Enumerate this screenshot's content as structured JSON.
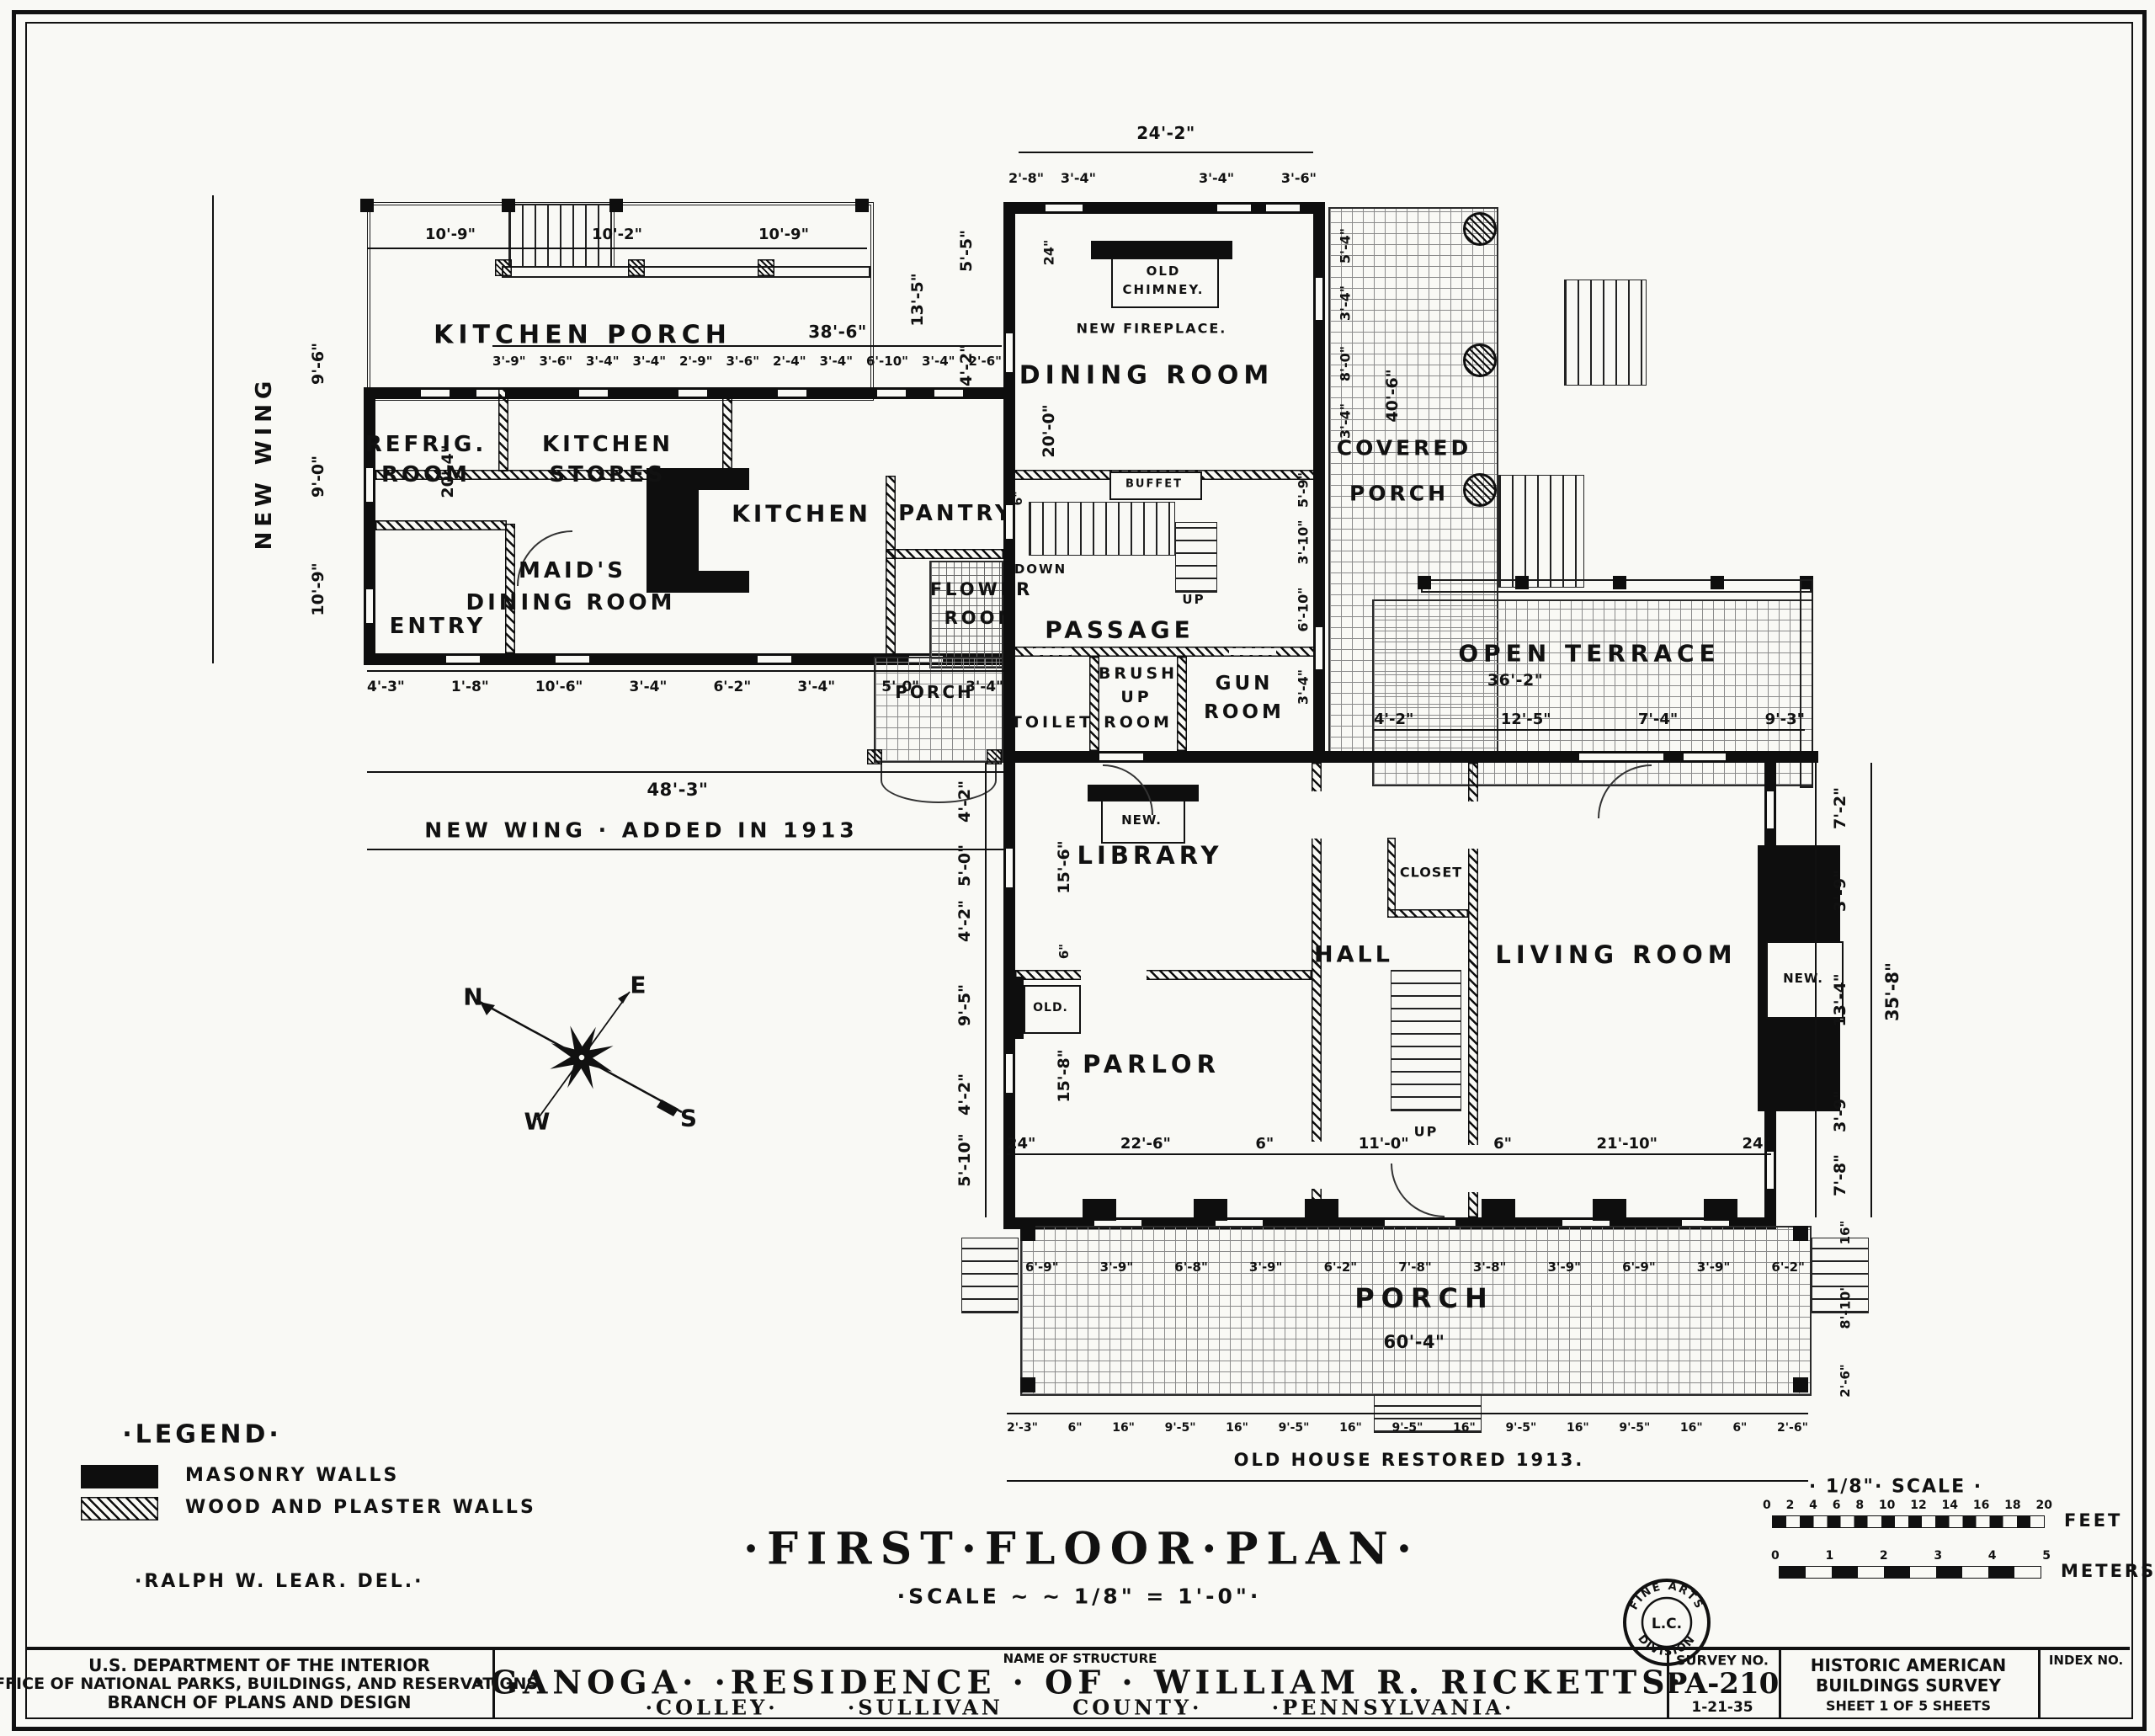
{
  "plan_title": {
    "title": "·FIRST·FLOOR·PLAN·",
    "scale": "·SCALE ~ ~ 1/8\" = 1'-0\"·"
  },
  "legend": {
    "title": "·LEGEND·",
    "masonry": "MASONRY WALLS",
    "wood": "WOOD AND PLASTER WALLS",
    "delineator": "·RALPH W. LEAR. DEL.·"
  },
  "scalebar": {
    "title": "· 1/8\"· SCALE ·",
    "feet_ticks": [
      "0",
      "2",
      "4",
      "6",
      "8",
      "10",
      "12",
      "14",
      "16",
      "18",
      "20"
    ],
    "feet_label": "FEET",
    "meter_ticks": [
      "0",
      "1",
      "2",
      "3",
      "4",
      "5"
    ],
    "meters_label": "METERS"
  },
  "compass": {
    "n": "N",
    "e": "E",
    "w": "W",
    "s": "S"
  },
  "stamp": {
    "arc_top": "FINE ARTS",
    "center": "L.C.",
    "arc_bottom": "DIVISION"
  },
  "titleblock": {
    "agency_line1": "U.S. DEPARTMENT OF THE INTERIOR",
    "agency_line2": "OFFICE OF NATIONAL PARKS, BUILDINGS, AND RESERVATIONS",
    "agency_line3": "BRANCH OF PLANS AND DESIGN",
    "name_label": "NAME OF STRUCTURE",
    "name_main": "·GANOGA·  ·RESIDENCE · OF · WILLIAM R. RICKETTS·",
    "name_sub": "·COLLEY· ·SULLIVAN COUNTY· ·PENNSYLVANIA·",
    "survey_label": "SURVEY NO.",
    "survey_no": "PA-210",
    "survey_date": "1-21-35",
    "habs_line1": "HISTORIC AMERICAN",
    "habs_line2": "BUILDINGS SURVEY",
    "sheet_info": "SHEET 1 OF 5 SHEETS",
    "index_label": "INDEX NO."
  },
  "annotations": {
    "new_wing_added": "NEW WING · ADDED IN 1913",
    "old_house_restored": "OLD HOUSE RESTORED 1913.",
    "new_wing_vertical": "NEW WING",
    "down": "DOWN",
    "up": "UP"
  },
  "rooms": {
    "kitchen_porch": "KITCHEN PORCH",
    "refrig_room": [
      "REFRIG.",
      "ROOM"
    ],
    "kitchen_stores": [
      "KITCHEN",
      "STORES"
    ],
    "kitchen": "KITCHEN",
    "pantry": "PANTRY",
    "maids_dining": [
      "MAID'S",
      "DINING ROOM"
    ],
    "entry": "ENTRY",
    "flower_room": [
      "FLOWER",
      "ROOM"
    ],
    "dining_room": "DINING ROOM",
    "old_chimney": [
      "OLD",
      "CHIMNEY."
    ],
    "new_fireplace": "NEW FIREPLACE.",
    "buffet": "BUFFET",
    "passage": "PASSAGE",
    "toilet": "TOILET",
    "brush_up_room": [
      "BRUSH",
      "UP",
      "ROOM"
    ],
    "gun_room": [
      "GUN",
      "ROOM"
    ],
    "covered_porch": [
      "COVERED",
      "PORCH"
    ],
    "open_terrace": "OPEN TERRACE",
    "library": "LIBRARY",
    "closet": "CLOSET",
    "hall": "HALL",
    "living_room": "LIVING ROOM",
    "parlor": "PARLOR",
    "porch_small": "PORCH",
    "porch_main": "PORCH",
    "fireplace_new": "NEW.",
    "fireplace_old": "OLD."
  },
  "dims": {
    "top_main": "24'-2\"",
    "top_sub_left": [
      "2'-8\"",
      "3'-4\""
    ],
    "top_sub_right": [
      "3'-4\"",
      "3'-6\""
    ],
    "kp_top": [
      "10'-9\"",
      "10'-2\"",
      "10'-9\""
    ],
    "kp_width": "38'-6\"",
    "window_row": [
      "3'-9\"",
      "3'-6\"",
      "3'-4\"",
      "3'-4\"",
      "2'-9\"",
      "3'-6\"",
      "2'-4\"",
      "3'-4\"",
      "6'-10\"",
      "3'-4\"",
      "2'-6\""
    ],
    "kp_right_a": "5'-5\"",
    "kp_right_b": "13'-5\"",
    "kp_right_c": "4'-2\"",
    "wing_left": [
      "9'-6\"",
      "9'-0\"",
      "10'-9\""
    ],
    "wing_depth": "20'-4\"",
    "wing_bottom": [
      "4'-3\"",
      "1'-8\"",
      "10'-6\"",
      "3'-4\"",
      "6'-2\"",
      "3'-4\"",
      "5'-0\"",
      "3'-4\""
    ],
    "wing_total": "48'-3\"",
    "dining_a": "24\"",
    "dining_b": "20'-0\"",
    "passage_a": "6\"",
    "cp_col_upper": [
      "5'-4\"",
      "3'-4\"",
      "8'-0\"",
      "3'-4\""
    ],
    "cp_col_lower": [
      "5'-9\"",
      "3'-10\"",
      "6'-10\"",
      "3'-4\""
    ],
    "cp_width": "40'-6\"",
    "terrace_width": "36'-2\"",
    "terrace_row": [
      "4'-2\"",
      "12'-5\"",
      "7'-4\"",
      "9'-3\""
    ],
    "house_left": [
      "4'-2\"",
      "5'-0\"",
      "4'-2\"",
      "9'-5\"",
      "4'-2\"",
      "5'-10\""
    ],
    "house_left_inner": [
      "15'-6\"",
      "6\"",
      "15'-8\""
    ],
    "south_row": [
      "24\"",
      "22'-6\"",
      "6\"",
      "11'-0\"",
      "6\"",
      "21'-10\"",
      "24\""
    ],
    "house_right": [
      "7'-2\"",
      "3'-9\"",
      "13'-4\"",
      "3'-9\"",
      "7'-8\""
    ],
    "house_right_total": "35'-8\"",
    "porch_row": [
      "6'-9\"",
      "3'-9\"",
      "6'-8\"",
      "3'-9\"",
      "6'-2\"",
      "7'-8\"",
      "3'-8\"",
      "3'-9\"",
      "6'-9\"",
      "3'-9\"",
      "6'-2\""
    ],
    "porch_width": "60'-4\"",
    "porch_bottom_row": [
      "2'-3\"",
      "6\"",
      "16\"",
      "9'-5\"",
      "16\"",
      "9'-5\"",
      "16\"",
      "9'-5\"",
      "16\"",
      "9'-5\"",
      "16\"",
      "9'-5\"",
      "16\"",
      "6\"",
      "2'-6\""
    ],
    "porch_right": [
      "16\"",
      "8'-10\"",
      "2'-6\""
    ]
  }
}
